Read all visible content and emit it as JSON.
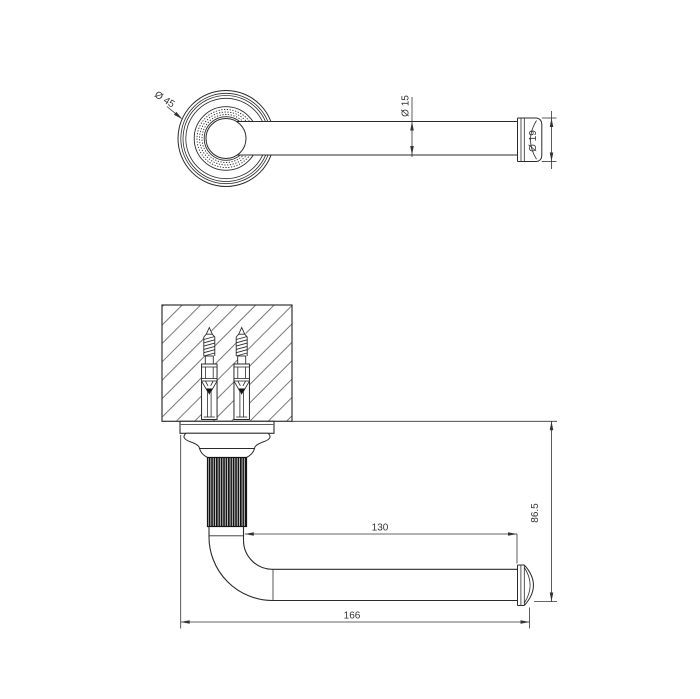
{
  "drawing": {
    "colors": {
      "background": "#ffffff",
      "line": "#2b2b2b",
      "dimension": "#333333",
      "hatch": "#555555"
    },
    "dimensions": {
      "rosette_diameter": "Ø 45",
      "tube_diameter": "Ø 15",
      "end_cap_diameter": "Ø 19",
      "arm_length": "130",
      "overall_length": "166",
      "overall_height": "86.5"
    }
  }
}
